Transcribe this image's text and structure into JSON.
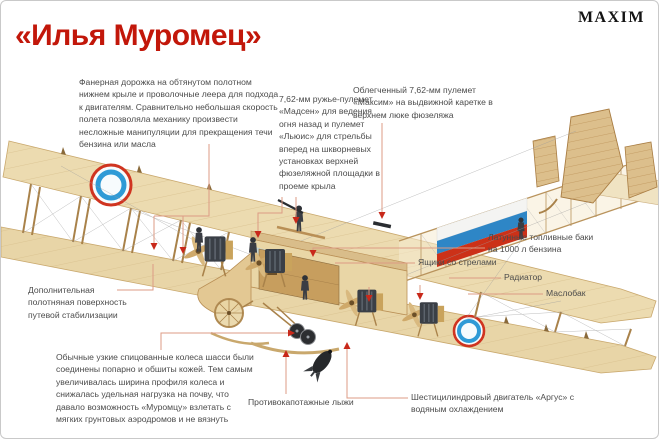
{
  "header": {
    "title": "«Илья Муромец»",
    "brand": "MAXIM"
  },
  "callouts": {
    "walkway": {
      "text": "Фанерная дорожка на обтянутом полотном нижнем крыле и проволочные леера для подхода к двигателям. Сравнительно небольшая скорость полета позволяла механику произвести несложные манипуляции для прекращения течи бензина или масла"
    },
    "madsen": {
      "text": "7,62-мм ружье-пулемет «Мадсен» для ведения огня назад и пулемет «Льюис» для стрельбы вперед на шкворневых установках верхней фюзеляжной площадки в проеме крыла"
    },
    "maxim_gun": {
      "text": "Облегченный 7,62-мм пулемет «Максим» на выдвижной каретке в верхнем люке фюзеляжа"
    },
    "fuel_tanks": {
      "text": "Латунные топливные баки на 1000 л бензина"
    },
    "arrow_boxes": {
      "text": "Ящики со стрелами"
    },
    "radiator": {
      "text": "Радиатор"
    },
    "oil_tank": {
      "text": "Маслобак"
    },
    "stabilizer": {
      "text": "Дополнительная полотняная поверхность путевой стабилизации"
    },
    "wheels": {
      "text": "Обычные узкие спицованные колеса шасси были соединены попарно и обшиты кожей. Тем самым увеличивалась ширина профиля колеса и снижалась удельная нагрузка на почву, что давало возможность «Муромцу» взлетать с мягких грунтовых аэродромов и не вязнуть"
    },
    "skis": {
      "text": "Противокапотажные лыжи"
    },
    "engine_argus": {
      "text": "Шестицилиндровый двигатель «Аргус» с водяным охлаждением"
    }
  },
  "illustration": {
    "roundel_colors": [
      "#f7fbfd",
      "#2f9ad6",
      "#d03420"
    ],
    "flag_colors": [
      "#f4f4f2",
      "#2e86c6",
      "#cc3118"
    ]
  },
  "colors": {
    "title_red": "#c2170a",
    "arrow_red": "#c8281a",
    "leader_line": "#dd9b84",
    "body_text": "#4b4b4b",
    "border": "#c9c9c9",
    "wing_cream": "#ecdbb0"
  }
}
